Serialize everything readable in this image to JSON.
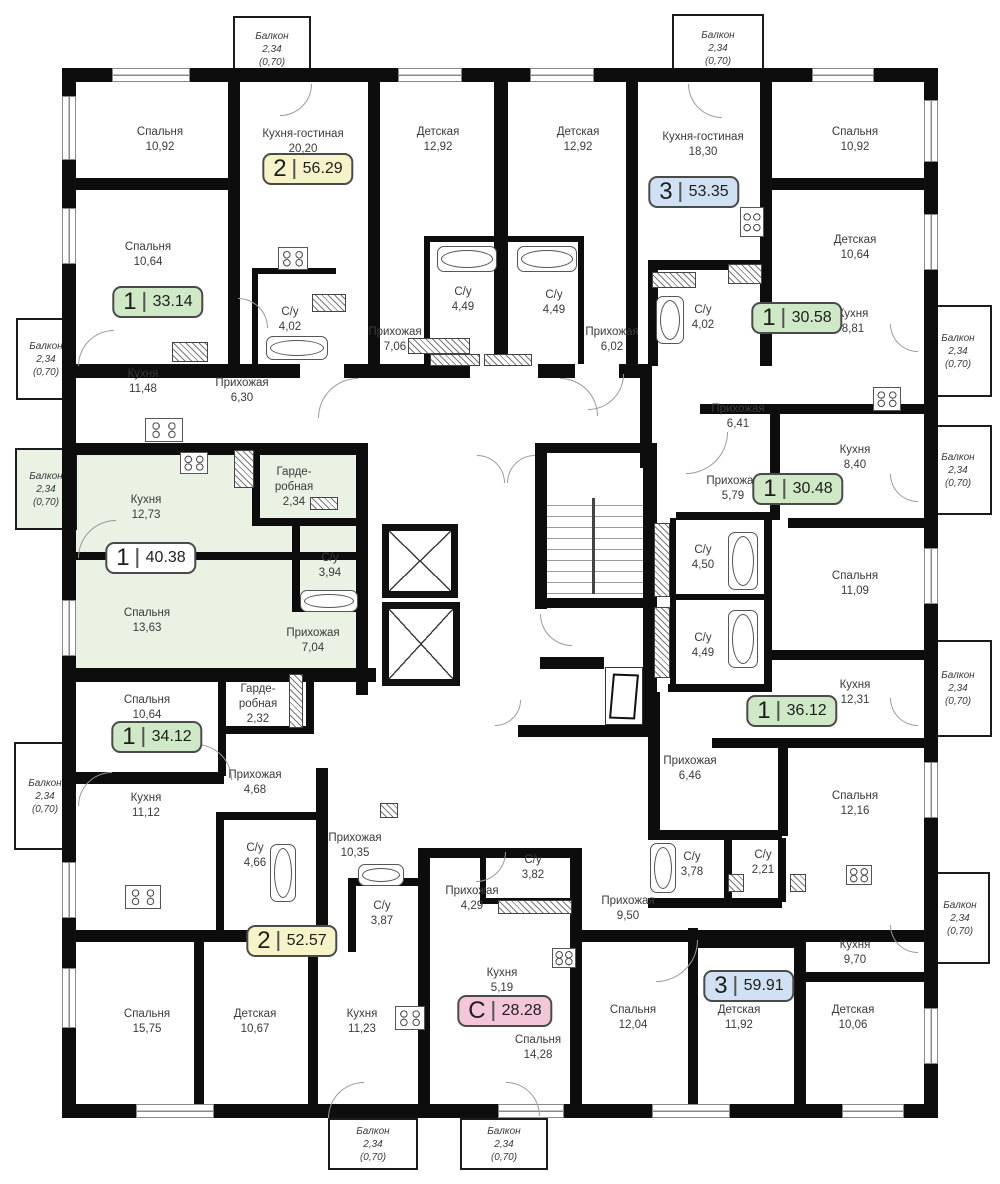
{
  "title": "Поэтажный план — план этажа с квартирами",
  "highlight_color": "#e9f2e3",
  "badge_colors": {
    "green": "#cfe8c6",
    "yellow": "#f7f3c9",
    "blue": "#cfe1f2",
    "pink": "#f3c6da",
    "white": "#ffffff"
  },
  "badges": [
    {
      "num": "2",
      "area": "56.29",
      "color": "#f7f3c9",
      "x": 308,
      "y": 169
    },
    {
      "num": "3",
      "area": "53.35",
      "color": "#cfe1f2",
      "x": 694,
      "y": 192
    },
    {
      "num": "1",
      "area": "33.14",
      "color": "#cfe8c6",
      "x": 158,
      "y": 302
    },
    {
      "num": "1",
      "area": "30.58",
      "color": "#cfe8c6",
      "x": 797,
      "y": 318
    },
    {
      "num": "1",
      "area": "30.48",
      "color": "#cfe8c6",
      "x": 798,
      "y": 489
    },
    {
      "num": "1",
      "area": "40.38",
      "color": "#ffffff",
      "x": 151,
      "y": 558
    },
    {
      "num": "1",
      "area": "36.12",
      "color": "#cfe8c6",
      "x": 792,
      "y": 711
    },
    {
      "num": "1",
      "area": "34.12",
      "color": "#cfe8c6",
      "x": 157,
      "y": 737
    },
    {
      "num": "2",
      "area": "52.57",
      "color": "#f7f3c9",
      "x": 292,
      "y": 941
    },
    {
      "num": "С",
      "area": "28.28",
      "color": "#f3c6da",
      "x": 505,
      "y": 1011
    },
    {
      "num": "3",
      "area": "59.91",
      "color": "#cfe1f2",
      "x": 749,
      "y": 986
    }
  ],
  "rooms": [
    {
      "name": "Спальня",
      "area": "10,92",
      "x": 160,
      "y": 140
    },
    {
      "name": "Кухня-гостиная",
      "area": "20,20",
      "x": 303,
      "y": 142
    },
    {
      "name": "Детская",
      "area": "12,92",
      "x": 438,
      "y": 140
    },
    {
      "name": "Детская",
      "area": "12,92",
      "x": 578,
      "y": 140
    },
    {
      "name": "Кухня-гостиная",
      "area": "18,30",
      "x": 703,
      "y": 145
    },
    {
      "name": "Спальня",
      "area": "10,92",
      "x": 855,
      "y": 140
    },
    {
      "name": "Спальня",
      "area": "10,64",
      "x": 148,
      "y": 255
    },
    {
      "name": "Детская",
      "area": "10,64",
      "x": 855,
      "y": 248
    },
    {
      "name": "С/у",
      "area": "4,02",
      "x": 290,
      "y": 320
    },
    {
      "name": "Прихожая",
      "area": "7,06",
      "x": 395,
      "y": 340
    },
    {
      "name": "С/у",
      "area": "4,49",
      "x": 463,
      "y": 300
    },
    {
      "name": "С/у",
      "area": "4,49",
      "x": 554,
      "y": 303
    },
    {
      "name": "Прихожая",
      "area": "6,02",
      "x": 612,
      "y": 340
    },
    {
      "name": "С/у",
      "area": "4,02",
      "x": 703,
      "y": 318
    },
    {
      "name": "Кухня",
      "area": "8,81",
      "x": 853,
      "y": 322
    },
    {
      "name": "Кухня",
      "area": "11,48",
      "x": 143,
      "y": 382
    },
    {
      "name": "Прихожая",
      "area": "6,30",
      "x": 242,
      "y": 391
    },
    {
      "name": "Прихожая",
      "area": "6,41",
      "x": 738,
      "y": 417
    },
    {
      "name": "Кухня",
      "area": "8,40",
      "x": 855,
      "y": 458
    },
    {
      "name": "Кухня",
      "area": "12,73",
      "x": 146,
      "y": 508
    },
    {
      "name": "Гарде-\nробная",
      "area": "2,34",
      "x": 294,
      "y": 488
    },
    {
      "name": "Прихожая",
      "area": "5,79",
      "x": 733,
      "y": 489
    },
    {
      "name": "С/у",
      "area": "3,94",
      "x": 330,
      "y": 566
    },
    {
      "name": "С/у",
      "area": "4,50",
      "x": 703,
      "y": 558
    },
    {
      "name": "Спальня",
      "area": "11,09",
      "x": 855,
      "y": 584
    },
    {
      "name": "Спальня",
      "area": "13,63",
      "x": 147,
      "y": 621
    },
    {
      "name": "Прихожая",
      "area": "7,04",
      "x": 313,
      "y": 641
    },
    {
      "name": "С/у",
      "area": "4,49",
      "x": 703,
      "y": 646
    },
    {
      "name": "Кухня",
      "area": "12,31",
      "x": 855,
      "y": 693
    },
    {
      "name": "Спальня",
      "area": "10,64",
      "x": 147,
      "y": 708
    },
    {
      "name": "Гарде-\nробная",
      "area": "2,32",
      "x": 258,
      "y": 705
    },
    {
      "name": "Прихожая",
      "area": "6,46",
      "x": 690,
      "y": 769
    },
    {
      "name": "Прихожая",
      "area": "4,68",
      "x": 255,
      "y": 783
    },
    {
      "name": "Кухня",
      "area": "11,12",
      "x": 146,
      "y": 806
    },
    {
      "name": "Спальня",
      "area": "12,16",
      "x": 855,
      "y": 804
    },
    {
      "name": "Прихожая",
      "area": "10,35",
      "x": 355,
      "y": 846
    },
    {
      "name": "С/у",
      "area": "4,66",
      "x": 255,
      "y": 856
    },
    {
      "name": "С/у",
      "area": "3,78",
      "x": 692,
      "y": 865
    },
    {
      "name": "С/у",
      "area": "2,21",
      "x": 763,
      "y": 863
    },
    {
      "name": "С/у",
      "area": "3,82",
      "x": 533,
      "y": 868
    },
    {
      "name": "Прихожая",
      "area": "4,29",
      "x": 472,
      "y": 899
    },
    {
      "name": "Прихожая",
      "area": "9,50",
      "x": 628,
      "y": 909
    },
    {
      "name": "С/у",
      "area": "3,87",
      "x": 382,
      "y": 914
    },
    {
      "name": "Кухня",
      "area": "9,70",
      "x": 855,
      "y": 953
    },
    {
      "name": "Кухня",
      "area": "5,19",
      "x": 502,
      "y": 981
    },
    {
      "name": "Спальня",
      "area": "15,75",
      "x": 147,
      "y": 1022
    },
    {
      "name": "Детская",
      "area": "10,67",
      "x": 255,
      "y": 1022
    },
    {
      "name": "Кухня",
      "area": "11,23",
      "x": 362,
      "y": 1022
    },
    {
      "name": "Спальня",
      "area": "12,04",
      "x": 633,
      "y": 1018
    },
    {
      "name": "Детская",
      "area": "11,92",
      "x": 739,
      "y": 1018
    },
    {
      "name": "Детская",
      "area": "10,06",
      "x": 853,
      "y": 1018
    },
    {
      "name": "Спальня",
      "area": "14,28",
      "x": 538,
      "y": 1048
    }
  ],
  "balconies": [
    {
      "name": "Балкон",
      "area": "2,34",
      "coef": "(0,70)",
      "x": 233,
      "y": 16,
      "w": 78,
      "h": 66,
      "green": false
    },
    {
      "name": "Балкон",
      "area": "2,34",
      "coef": "(0,70)",
      "x": 672,
      "y": 14,
      "w": 92,
      "h": 68,
      "green": false
    },
    {
      "name": "Балкон",
      "area": "2,34",
      "coef": "(0,70)",
      "x": 16,
      "y": 318,
      "w": 60,
      "h": 82,
      "green": false
    },
    {
      "name": "Балкон",
      "area": "2,34",
      "coef": "(0,70)",
      "x": 15,
      "y": 448,
      "w": 62,
      "h": 82,
      "green": true
    },
    {
      "name": "Балкон",
      "area": "2,34",
      "coef": "(0,70)",
      "x": 14,
      "y": 742,
      "w": 62,
      "h": 108,
      "green": false
    },
    {
      "name": "Балкон",
      "area": "2,34",
      "coef": "(0,70)",
      "x": 924,
      "y": 305,
      "w": 68,
      "h": 92,
      "green": false
    },
    {
      "name": "Балкон",
      "area": "2,34",
      "coef": "(0,70)",
      "x": 924,
      "y": 425,
      "w": 68,
      "h": 90,
      "green": false
    },
    {
      "name": "Балкон",
      "area": "2,34",
      "coef": "(0,70)",
      "x": 924,
      "y": 640,
      "w": 68,
      "h": 97,
      "green": false
    },
    {
      "name": "Балкон",
      "area": "2,34",
      "coef": "(0,70)",
      "x": 930,
      "y": 872,
      "w": 60,
      "h": 92,
      "green": false
    },
    {
      "name": "Балкон",
      "area": "2,34",
      "coef": "(0,70)",
      "x": 328,
      "y": 1118,
      "w": 90,
      "h": 52,
      "green": false
    },
    {
      "name": "Балкон",
      "area": "2,34",
      "coef": "(0,70)",
      "x": 460,
      "y": 1118,
      "w": 88,
      "h": 52,
      "green": false
    }
  ]
}
